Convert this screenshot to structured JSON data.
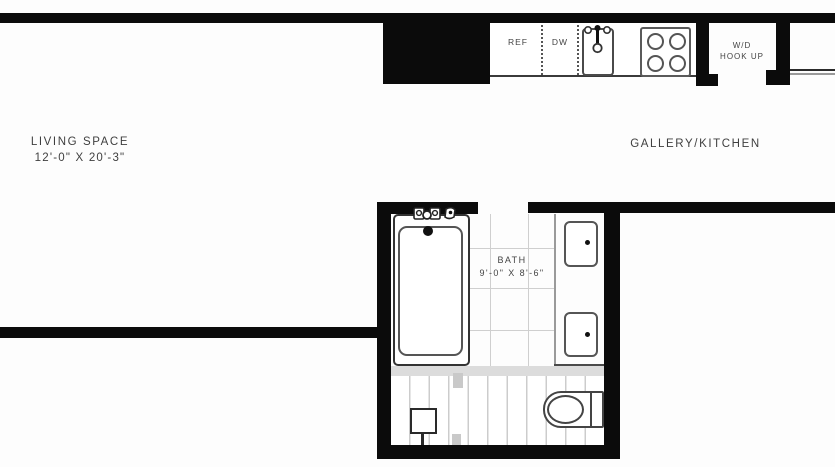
{
  "rooms": {
    "living": {
      "name": "LIVING SPACE",
      "dims": "12'-0\" X 20'-3\""
    },
    "gallery": {
      "name": "GALLERY/KITCHEN"
    },
    "bath": {
      "name": "BATH",
      "dims": "9'-0\" X 8'-6\""
    },
    "wd": {
      "line1": "W/D",
      "line2": "HOOK UP"
    }
  },
  "appliances": {
    "refrigerator": "REF",
    "dishwasher": "DW"
  },
  "fixture_names": [
    "kitchen-sink",
    "stove",
    "bathtub",
    "vanity-sink-upper",
    "vanity-sink-lower",
    "toilet",
    "shower-fixture",
    "wd-hookup-closet"
  ],
  "colors": {
    "wall": "#0b0b0b",
    "text": "#3a3a3a",
    "fixture_outline": "#444444",
    "tile_line": "#cfcfcf",
    "threshold": "#dcdcdc",
    "background": "#fdfdfd"
  }
}
